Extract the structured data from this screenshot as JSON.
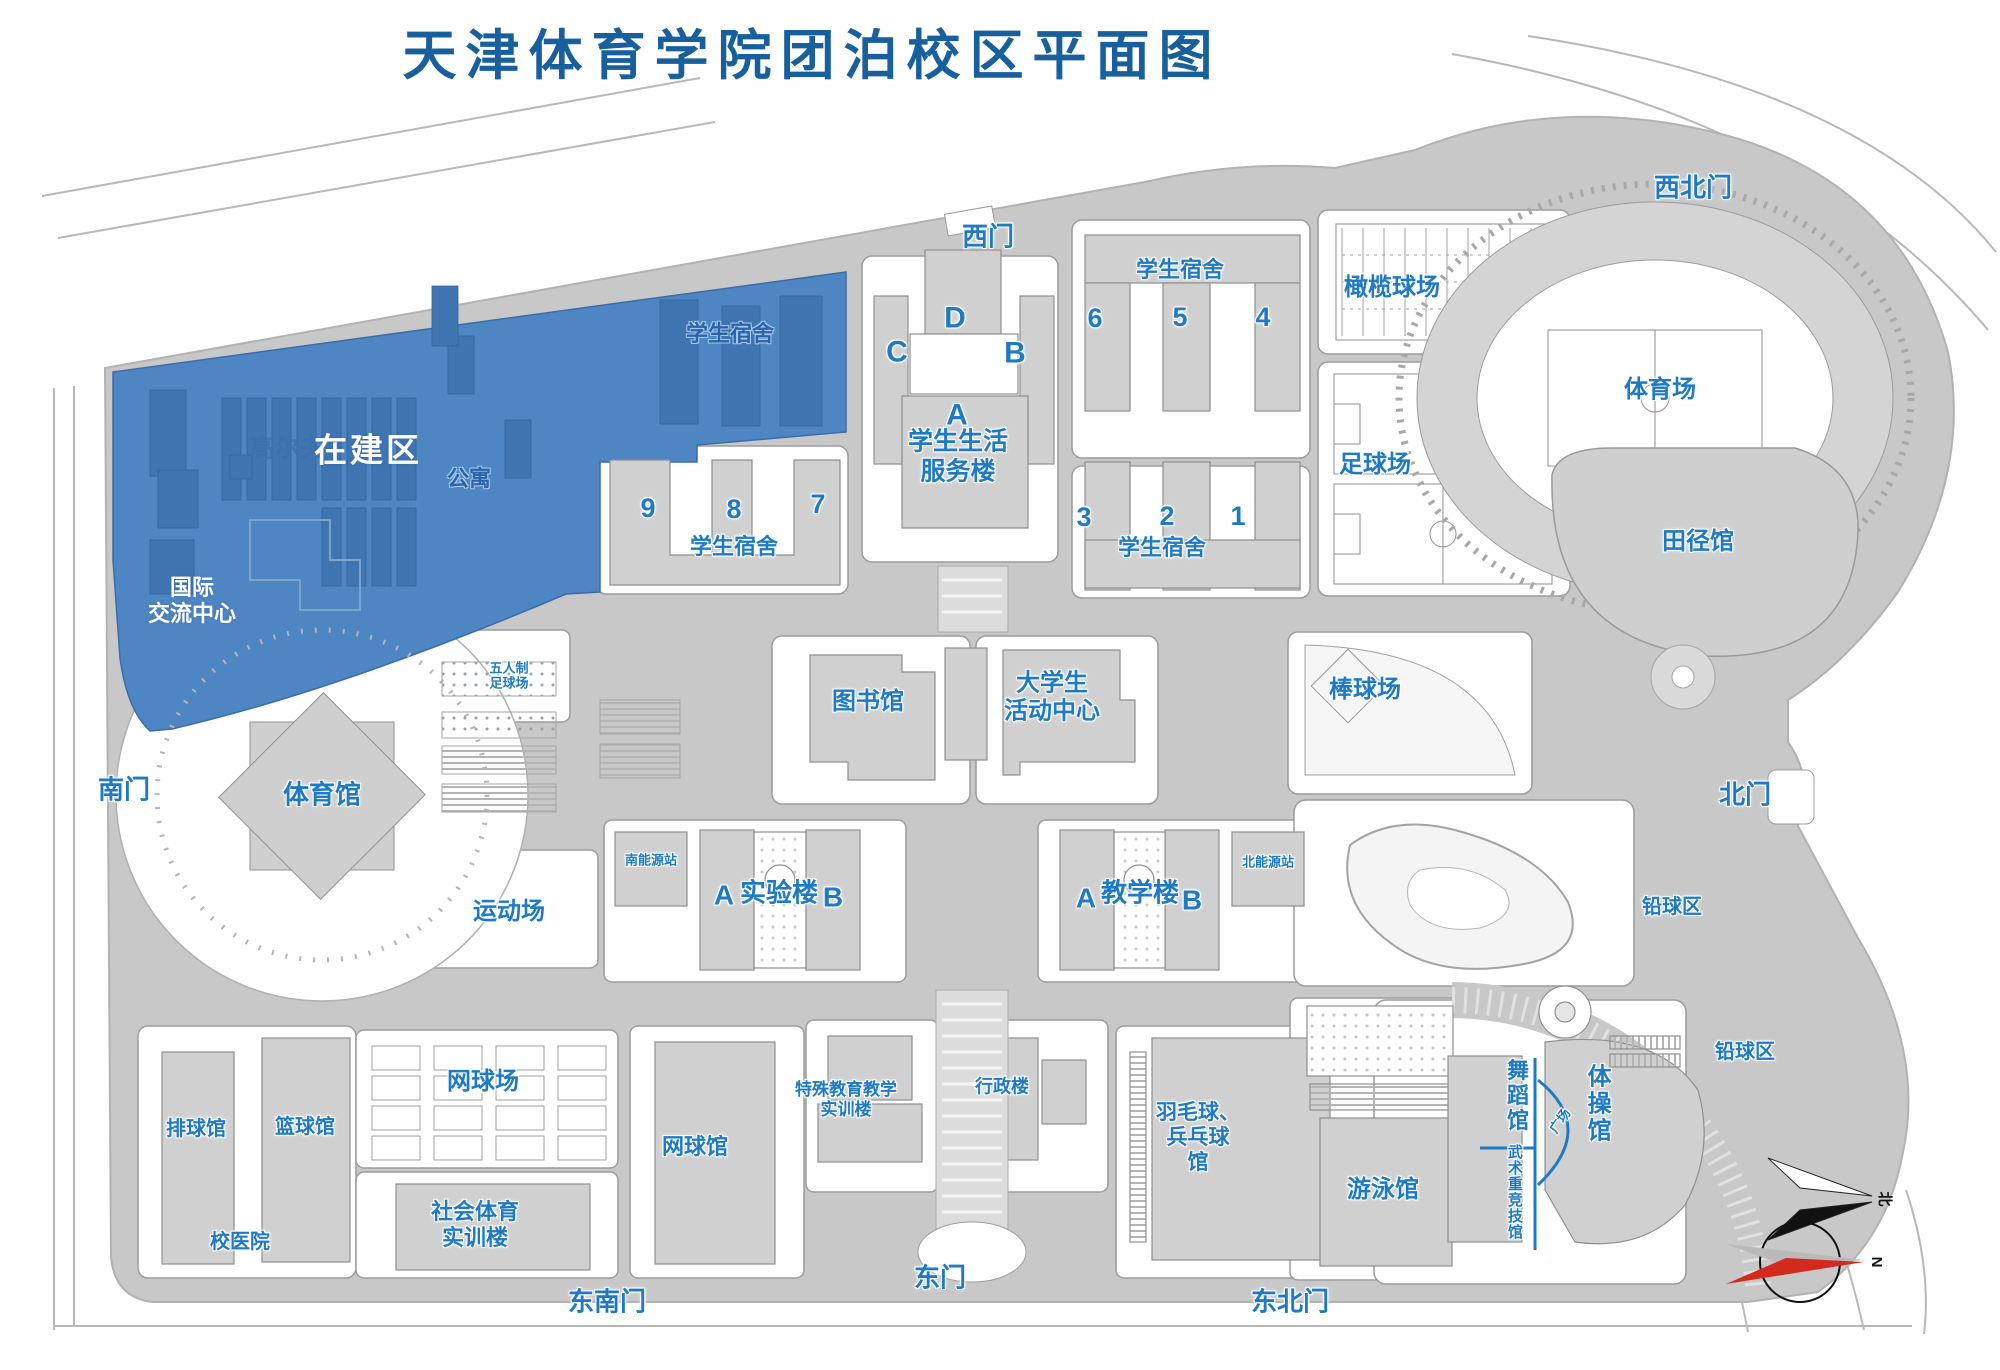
{
  "title": "天津体育学院团泊校区平面图",
  "gates": {
    "west": "西门",
    "northwest": "西北门",
    "south": "南门",
    "north": "北门",
    "east": "东门",
    "southeast": "东南门",
    "northeast": "东北门"
  },
  "construction_zone": {
    "label": "在建区",
    "golf": "高尔夫",
    "apartment": "公寓",
    "intl_line1": "国际",
    "intl_line2": "交流中心",
    "dorm_label": "学生宿舍"
  },
  "dormitories": {
    "label": "学生宿舍",
    "n1": "1",
    "n2": "2",
    "n3": "3",
    "n4": "4",
    "n5": "5",
    "n6": "6",
    "n7": "7",
    "n8": "8",
    "n9": "9"
  },
  "service_building": {
    "wing_a": "A",
    "wing_b": "B",
    "wing_c": "C",
    "wing_d": "D",
    "line1": "学生生活",
    "line2": "服务楼"
  },
  "academic": {
    "library": "图书馆",
    "activity_line1": "大学生",
    "activity_line2": "活动中心",
    "lab": "实验楼",
    "lab_a": "A",
    "lab_b": "B",
    "teaching": "教学楼",
    "teaching_a": "A",
    "teaching_b": "B",
    "special_line1": "特殊教育教学",
    "special_line2": "实训楼",
    "admin": "行政楼",
    "social_line1": "社会体育",
    "social_line2": "实训楼",
    "hospital": "校医院"
  },
  "energy": {
    "south": "南能源站",
    "north": "北能源站"
  },
  "venues": {
    "gymnasium": "体育馆",
    "stadium": "体育场",
    "athletics_hall": "田径馆",
    "volleyball": "排球馆",
    "basketball": "篮球馆",
    "tennis_hall": "网球馆",
    "badminton_line1": "羽毛球、",
    "badminton_line2": "兵乓球",
    "badminton_line3": "馆",
    "swimming": "游泳馆",
    "dance": "舞蹈馆",
    "gymnastics": "体操馆",
    "martial": "武术重竞技馆",
    "plaza": "广场"
  },
  "fields": {
    "rugby": "橄榄球场",
    "football": "足球场",
    "baseball": "棒球场",
    "five_line1": "五人制",
    "five_line2": "足球场",
    "sports_ground": "运动场",
    "tennis_courts": "网球场",
    "shotput": "铅球区"
  },
  "compass": {
    "north_char": "北",
    "north_letter": "N"
  },
  "colors": {
    "title_blue": "#185f9e",
    "label_blue": "#1e7ac4",
    "construction_fill": "#4e86c3",
    "construction_building": "#3f76b2",
    "road_gray": "#c8c8c8",
    "building_gray": "#d0d0d0"
  }
}
